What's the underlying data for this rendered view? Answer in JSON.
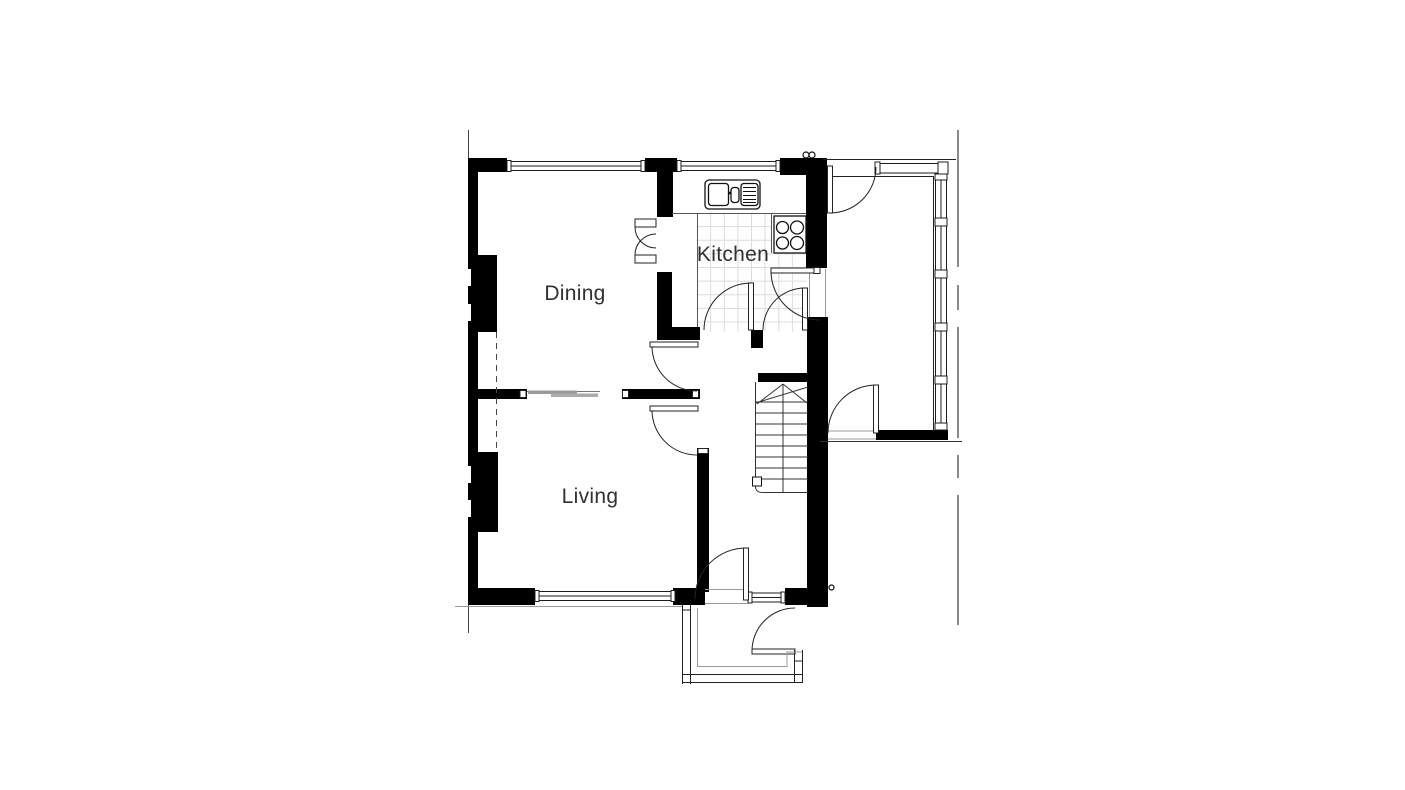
{
  "plan": {
    "type": "architectural-floor-plan",
    "rooms": [
      {
        "id": "dining",
        "label": "Dining"
      },
      {
        "id": "kitchen",
        "label": "Kitchen"
      },
      {
        "id": "living",
        "label": "Living"
      }
    ],
    "colors": {
      "wall": "#000000",
      "line": "#222222",
      "light_line": "#999999",
      "boundary": "#8a8a8a",
      "tile_grid": "#dcdcdc",
      "slider_panel": "#9b9b9b",
      "text": "#303030"
    }
  }
}
